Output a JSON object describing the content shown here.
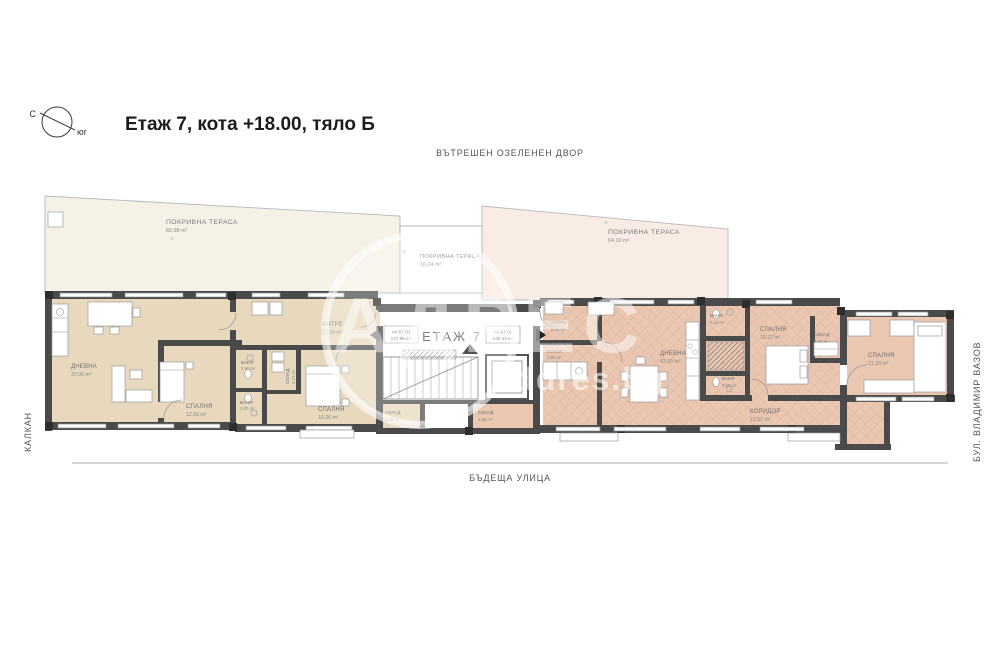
{
  "header": {
    "title": "Етаж 7, кота +18.00, тяло Б",
    "compass_north": "С",
    "compass_south": "юг"
  },
  "surroundings": {
    "top": "ВЪТРЕШЕН ОЗЕЛЕНЕН ДВОР",
    "bottom": "БЪДЕЩА УЛИЦА",
    "left": "КАЛКАН",
    "right": "БУЛ. ВЛАДИМИР ВАЗОВ"
  },
  "core": {
    "floor_label": "ЕТАЖ 7",
    "apartments": [
      {
        "id": "Ап Б7 01",
        "area": "127.58 m²"
      },
      {
        "id": "Ап Б7 02",
        "area": "145.33 m²"
      }
    ]
  },
  "terraces": [
    {
      "name": "ПОКРИВНА ТЕРАСА",
      "area": "66.98 m²"
    },
    {
      "name": "ПОКРИВНА ТЕРАСА",
      "area": "16.24 m²"
    },
    {
      "name": "ПОКРИВНА ТЕРАСА",
      "area": "64.10 m²"
    }
  ],
  "rooms": [
    {
      "name": "ДНЕВНА",
      "area": "37.06 m²"
    },
    {
      "name": "СПАЛНЯ",
      "area": "12.69 m²"
    },
    {
      "name": "АНТРЕ",
      "area": "23.28 m²"
    },
    {
      "name": "БАНЯ",
      "area": "2.90 m²"
    },
    {
      "name": "СКЛАД",
      "area": "3.21 m²"
    },
    {
      "name": "БАНЯ",
      "area": "2.00 m²"
    },
    {
      "name": "СПАЛНЯ",
      "area": "16.26 m²"
    },
    {
      "name": "СКЛАД",
      "area": "2.08 m²"
    },
    {
      "name": "СКЛАД",
      "area": "2.98 m²"
    },
    {
      "name": "АНТРЕ",
      "area": "8.21 m²"
    },
    {
      "name": "КУХНЯ",
      "area": "1.58 m²"
    },
    {
      "name": "ДНЕВНА",
      "area": "42.93 m²"
    },
    {
      "name": "БАНЯ",
      "area": "5.22 m²"
    },
    {
      "name": "СПАЛНЯ",
      "area": "16.22 m²"
    },
    {
      "name": "СКЛАД",
      "area": "3.07 m²"
    },
    {
      "name": "БАНЯ",
      "area": "3.59 m²"
    },
    {
      "name": "КОРИДОР",
      "area": "10.52 m²"
    },
    {
      "name": "СПАЛНЯ",
      "area": "21.28 m²"
    }
  ],
  "marks": {
    "x_mark": "×"
  },
  "watermark": {
    "big": "АДРЕС",
    "small": "addres.bg"
  },
  "colors": {
    "wall": "#4a4a4a",
    "left_apartment_floor": "#e8d8bd",
    "right_apartment_floor": "#eac7b1",
    "terrace_left": "#f6f1e6",
    "terrace_right": "#f9ece4"
  }
}
